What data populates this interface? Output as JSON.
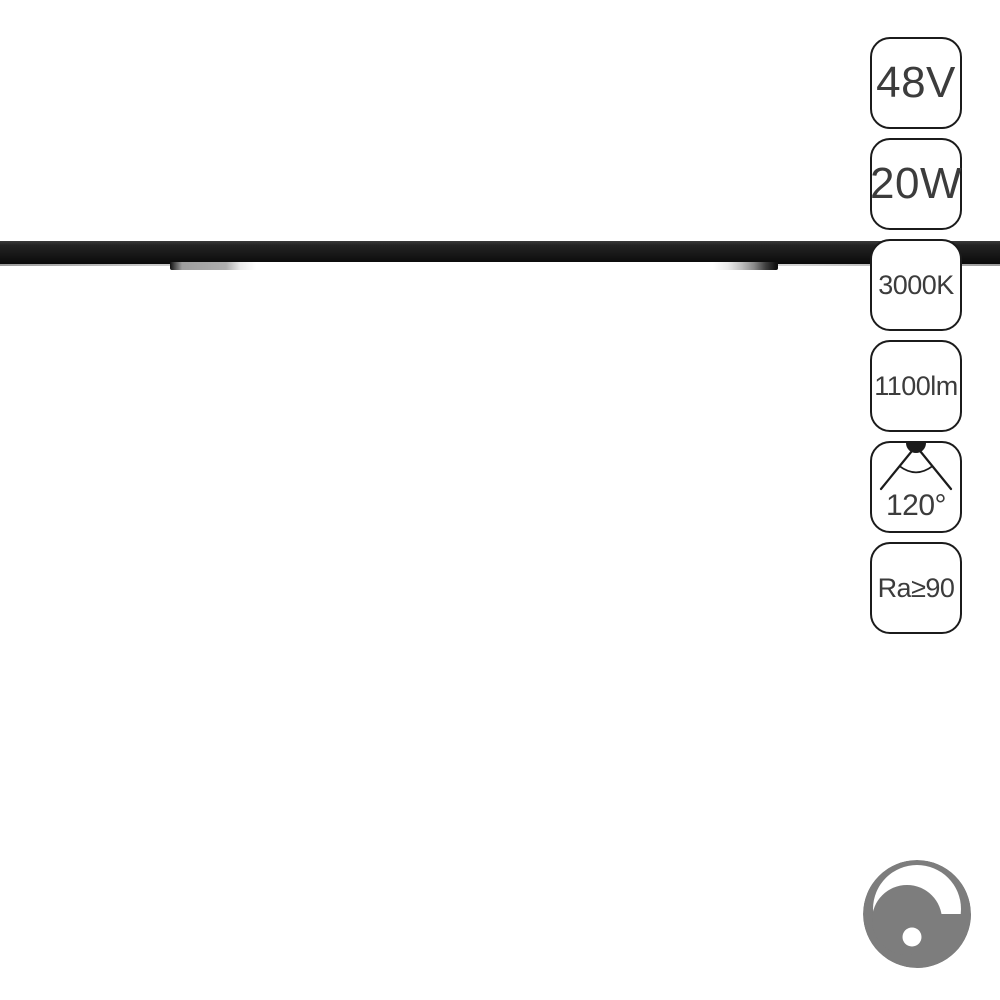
{
  "product_image": {
    "subject": "black linear magnetic track light, lit LED diffuser strip",
    "background_color": "#ffffff"
  },
  "spec_badges": [
    {
      "name": "voltage",
      "label": "48V"
    },
    {
      "name": "power",
      "label": "20W"
    },
    {
      "name": "color_temperature",
      "label": "3000K"
    },
    {
      "name": "luminous_flux",
      "label": "1100lm"
    },
    {
      "name": "beam_angle",
      "label": "120°",
      "icon": "beam-angle-icon"
    },
    {
      "name": "color_rendering_index",
      "label": "Ra≥90"
    }
  ],
  "icons": {
    "beam_angle": "beam-angle-icon",
    "dimmable": "dimmer-knob-icon"
  },
  "colors": {
    "badge_border": "#1b1b1b",
    "badge_text": "#3c3c3c",
    "track_rail": "#171717",
    "diffuser_lit": "#ffffff",
    "dimmer_gray": "#7d7d7d"
  }
}
